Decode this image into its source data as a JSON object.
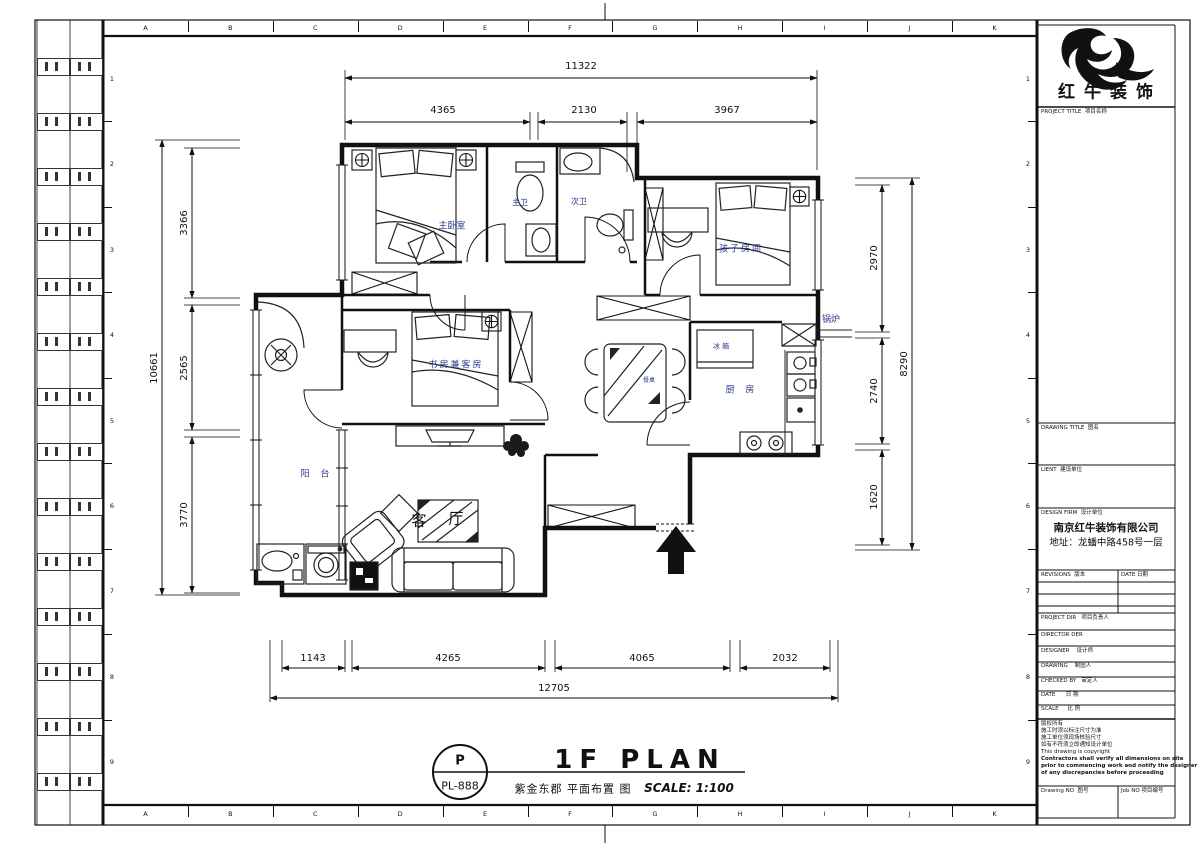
{
  "frame": {
    "top_letters": [
      "A",
      "B",
      "C",
      "D",
      "E",
      "F",
      "G",
      "H",
      "I",
      "J",
      "K"
    ],
    "bottom_letters": [
      "A",
      "B",
      "C",
      "D",
      "E",
      "F",
      "G",
      "H",
      "I",
      "J",
      "K"
    ],
    "side_numbers": [
      "1",
      "2",
      "3",
      "4",
      "5",
      "6",
      "7",
      "8",
      "9"
    ]
  },
  "titleblock": {
    "brand": "红牛装饰",
    "rows": {
      "project_title": "PROJECT TITLE  项目名称",
      "drawing_title": "DRAWING TITLE  图名",
      "client": "LIENT  建设单位",
      "design_firm": "DESIGN FIRM  设计单位",
      "firm_name": "南京红牛装饰有限公司",
      "firm_address": "地址：龙蟠中路458号一层",
      "revisions": "REVISIONS  版本",
      "revisions_date": "DATE 日期",
      "project_dir": "PROJECT DIR   项目负责人",
      "director": "DIRECTOR DER",
      "designer": "DESIGNER    设计师",
      "drawing": "DRAWING    制图人",
      "checked_by": "CHECKED BY   审定人",
      "date": "DATE      日 期",
      "scale": "SCALE     比 例",
      "drawing_no": "Drawing NO  图号",
      "job_no": "Job NO 项目编号"
    },
    "copyright": [
      "版权所有",
      "施工时须以标注尺寸为准",
      "施工单位须现场核验尺寸",
      "如有不符须立即通知设计单位",
      "This drawing is copyright",
      "Contractors shall verify all dimensions on site",
      "prior to commencing work and notify the designer",
      "of any discrepancies before proceeding"
    ]
  },
  "plan": {
    "rooms": {
      "master_bedroom": "主卧室",
      "master_bath": "主卫",
      "second_bath": "次卫",
      "kids_room": "孩子房间",
      "study_guest": "书房兼客房",
      "kitchen": "厨 房",
      "fridge": "冰 箱",
      "boiler": "锅炉",
      "balcony": "阳 台",
      "living_1": "客",
      "living_2": "厅",
      "dining_table": "餐桌"
    },
    "dims": {
      "top_total": "11322",
      "top": [
        "4365",
        "2130",
        "3967"
      ],
      "left_total": "10661",
      "left": [
        "3366",
        "2565",
        "3770"
      ],
      "right_total": "8290",
      "right": [
        "2970",
        "2740",
        "1620"
      ],
      "bottom": [
        "1143",
        "4265",
        "4065",
        "2032"
      ],
      "bottom_total": "12705"
    }
  },
  "footer": {
    "tag_top": "P",
    "tag_bottom": "PL-888",
    "title": "1F PLAN",
    "subtitle": "紫金东郡 平面布置 图",
    "scale": "SCALE: 1:100"
  }
}
